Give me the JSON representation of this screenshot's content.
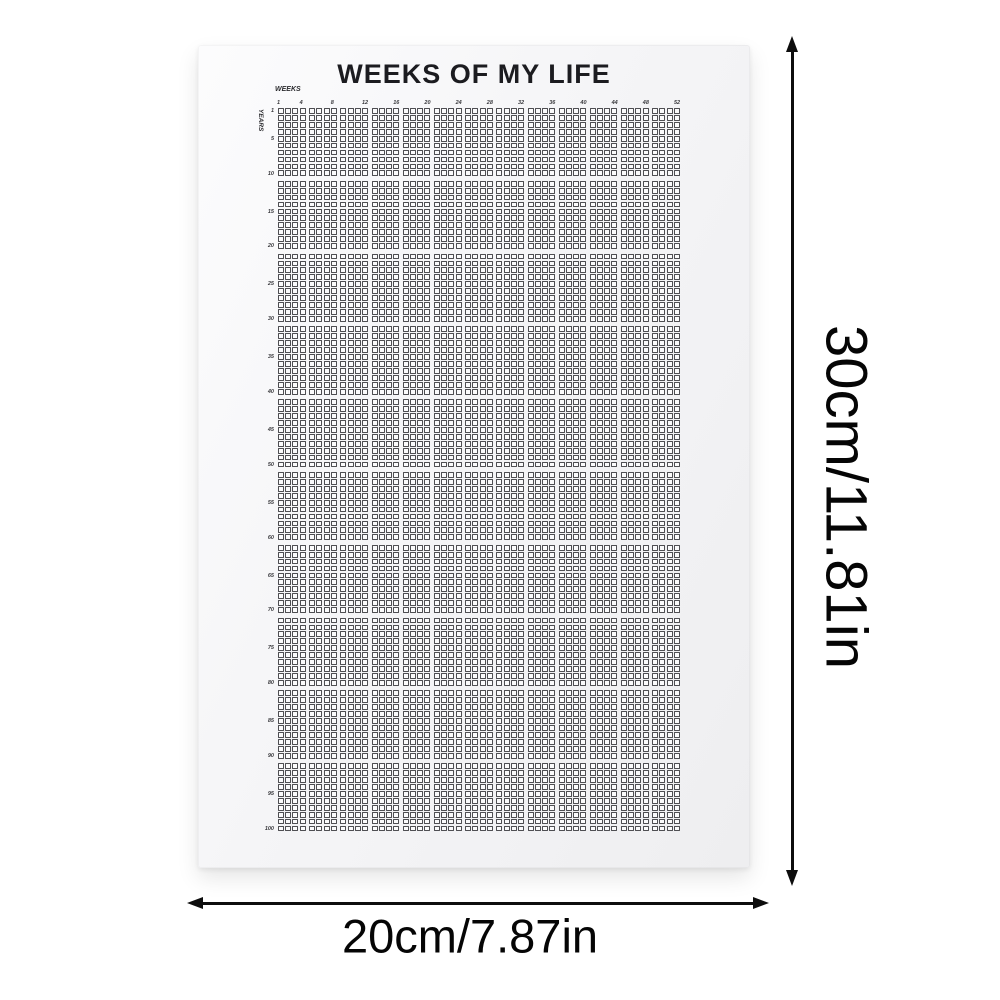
{
  "poster": {
    "title": "WEEKS OF MY LIFE",
    "weeks_axis_label": "WEEKS",
    "years_axis_label": "YEARS",
    "grid": {
      "weeks_per_year": 52,
      "total_years": 100,
      "weeks_per_block": 4,
      "years_per_block": 10,
      "week_ticks": [
        1,
        4,
        8,
        12,
        16,
        20,
        24,
        28,
        32,
        36,
        40,
        44,
        48,
        52
      ],
      "year_ticks": [
        1,
        5,
        10,
        15,
        20,
        25,
        30,
        35,
        40,
        45,
        50,
        55,
        60,
        65,
        70,
        75,
        80,
        85,
        90,
        95,
        100
      ],
      "cell_state": "empty"
    },
    "colors": {
      "ink": "#1c1c20",
      "cell_border": "#4e4e52",
      "paper": "#f4f4f6"
    }
  },
  "dimensions": {
    "height_label": "30cm/11.81in",
    "width_label": "20cm/7.87in"
  }
}
